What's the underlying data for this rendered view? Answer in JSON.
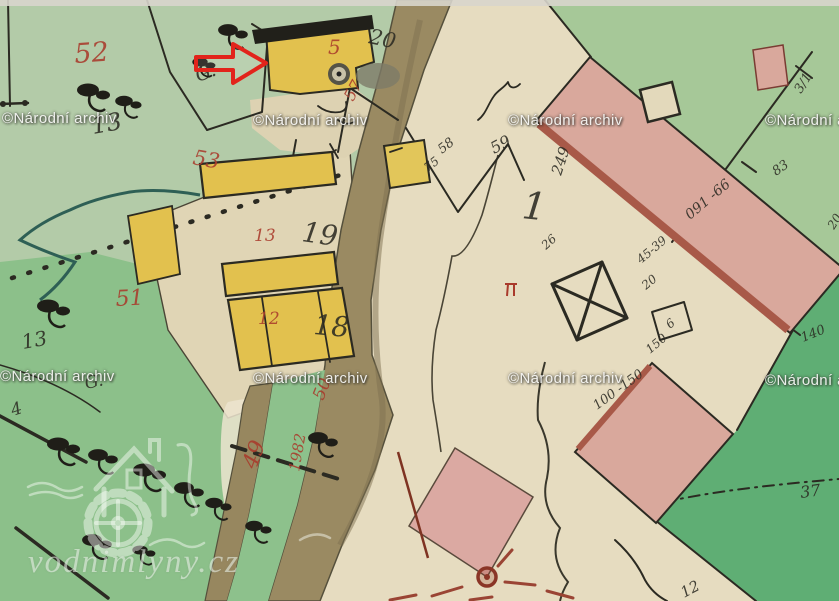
{
  "watermark": {
    "archive": "©Národní archiv",
    "logo_text": "vodnimlyny.cz"
  },
  "map": {
    "colors": {
      "red_ink": "#a93a2b",
      "black_ink": "#2b2a22",
      "arrow_red": "#e2241b",
      "yellow_building": "#e2c14e",
      "masonry_pink": "#d9a89c",
      "road_brown": "#9a8a62",
      "meadow_green": "#8cc08a",
      "field_beige": "#e6dcc0"
    },
    "labels": [
      {
        "t": "52",
        "x": 75,
        "y": 63,
        "s": 27,
        "c": "r",
        "a": -4
      },
      {
        "t": "13",
        "x": 93,
        "y": 134,
        "s": 24,
        "c": "k",
        "a": -10
      },
      {
        "t": "53",
        "x": 192,
        "y": 164,
        "s": 21,
        "c": "r",
        "a": 10
      },
      {
        "t": "G.",
        "x": 198,
        "y": 82,
        "s": 19,
        "c": "k",
        "a": -20
      },
      {
        "t": "20",
        "x": 368,
        "y": 43,
        "s": 21,
        "c": "k",
        "a": 12
      },
      {
        "t": "5",
        "x": 328,
        "y": 54,
        "s": 20,
        "c": "r",
        "a": 0
      },
      {
        "t": "57",
        "x": 353,
        "y": 102,
        "s": 16,
        "c": "r",
        "a": -62
      },
      {
        "t": "58",
        "x": 442,
        "y": 154,
        "s": 13,
        "c": "k",
        "a": -38
      },
      {
        "t": "75",
        "x": 428,
        "y": 172,
        "s": 12,
        "c": "k",
        "a": -38
      },
      {
        "t": "59",
        "x": 494,
        "y": 154,
        "s": 16,
        "c": "k",
        "a": -28
      },
      {
        "t": "1",
        "x": 521,
        "y": 218,
        "s": 38,
        "c": "k",
        "a": 6
      },
      {
        "t": "249",
        "x": 561,
        "y": 176,
        "s": 15,
        "c": "k",
        "a": -72
      },
      {
        "t": "26",
        "x": 546,
        "y": 250,
        "s": 12,
        "c": "k",
        "a": -42
      },
      {
        "t": "091 -66",
        "x": 690,
        "y": 220,
        "s": 14,
        "c": "k",
        "a": -40
      },
      {
        "t": "45-39",
        "x": 641,
        "y": 264,
        "s": 12,
        "c": "k",
        "a": -40
      },
      {
        "t": "20",
        "x": 646,
        "y": 290,
        "s": 12,
        "c": "k",
        "a": -40
      },
      {
        "t": "6",
        "x": 670,
        "y": 329,
        "s": 12,
        "c": "k",
        "a": -40
      },
      {
        "t": "150",
        "x": 650,
        "y": 354,
        "s": 12,
        "c": "k",
        "a": -40
      },
      {
        "t": "100 -150",
        "x": 597,
        "y": 410,
        "s": 13,
        "c": "k",
        "a": -36
      },
      {
        "t": "140",
        "x": 803,
        "y": 342,
        "s": 13,
        "c": "k",
        "a": -22
      },
      {
        "t": "83",
        "x": 776,
        "y": 176,
        "s": 13,
        "c": "k",
        "a": -35
      },
      {
        "t": "3/1",
        "x": 801,
        "y": 94,
        "s": 13,
        "c": "k",
        "a": -58
      },
      {
        "t": "20",
        "x": 834,
        "y": 230,
        "s": 12,
        "c": "k",
        "a": -58
      },
      {
        "t": "51",
        "x": 116,
        "y": 306,
        "s": 22,
        "c": "r",
        "a": -3
      },
      {
        "t": "13",
        "x": 254,
        "y": 241,
        "s": 17,
        "c": "r",
        "a": 0
      },
      {
        "t": "19",
        "x": 301,
        "y": 241,
        "s": 28,
        "c": "k",
        "a": 8
      },
      {
        "t": "12",
        "x": 258,
        "y": 324,
        "s": 17,
        "c": "r",
        "a": 0
      },
      {
        "t": "18",
        "x": 313,
        "y": 334,
        "s": 28,
        "c": "k",
        "a": 5
      },
      {
        "t": "50",
        "x": 323,
        "y": 401,
        "s": 17,
        "c": "r",
        "a": -68
      },
      {
        "t": "1982",
        "x": 299,
        "y": 472,
        "s": 15,
        "c": "r",
        "a": -80
      },
      {
        "t": "49",
        "x": 256,
        "y": 470,
        "s": 22,
        "c": "r",
        "a": -70
      },
      {
        "t": "13",
        "x": 23,
        "y": 349,
        "s": 20,
        "c": "k",
        "a": -10
      },
      {
        "t": "G.",
        "x": 86,
        "y": 389,
        "s": 17,
        "c": "k",
        "a": -12
      },
      {
        "t": "4",
        "x": 13,
        "y": 416,
        "s": 17,
        "c": "k",
        "a": -18
      },
      {
        "t": "37",
        "x": 801,
        "y": 498,
        "s": 16,
        "c": "k",
        "a": -8
      },
      {
        "t": "12",
        "x": 684,
        "y": 598,
        "s": 15,
        "c": "k",
        "a": -28
      }
    ],
    "tree_symbols": [
      {
        "x": 88,
        "y": 90,
        "k": 1
      },
      {
        "x": 124,
        "y": 101,
        "k": 0.8
      },
      {
        "x": 228,
        "y": 30,
        "k": 0.9
      },
      {
        "x": 200,
        "y": 62,
        "k": 0.7
      },
      {
        "x": 48,
        "y": 306,
        "k": 1
      },
      {
        "x": 318,
        "y": 438,
        "k": 0.9
      },
      {
        "x": 58,
        "y": 444,
        "k": 1
      },
      {
        "x": 98,
        "y": 455,
        "k": 0.9
      },
      {
        "x": 144,
        "y": 470,
        "k": 1
      },
      {
        "x": 184,
        "y": 488,
        "k": 0.9
      },
      {
        "x": 214,
        "y": 503,
        "k": 0.8
      },
      {
        "x": 92,
        "y": 540,
        "k": 0.9
      },
      {
        "x": 254,
        "y": 526,
        "k": 0.8
      },
      {
        "x": 140,
        "y": 550,
        "k": 0.7
      }
    ]
  }
}
